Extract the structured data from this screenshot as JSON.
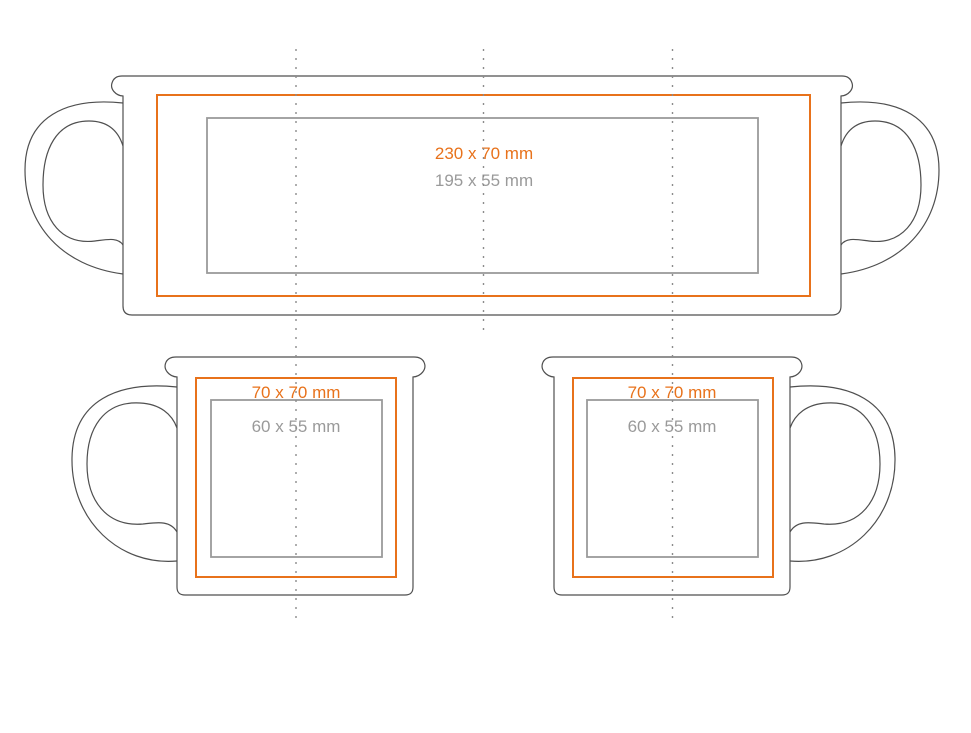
{
  "colors": {
    "print_area": "#e8721b",
    "safe_area": "#9a9a9a",
    "mug_outline": "#4f4f4f",
    "fold_line": "#8c8c8c"
  },
  "wrap_view": {
    "print_area_label": "230 x 70 mm",
    "safe_area_label": "195 x 55 mm"
  },
  "side_view_left": {
    "print_area_label": "70 x 70 mm",
    "safe_area_label": "60 x 55 mm"
  },
  "side_view_right": {
    "print_area_label": "70 x 70 mm",
    "safe_area_label": "60 x 55 mm"
  }
}
